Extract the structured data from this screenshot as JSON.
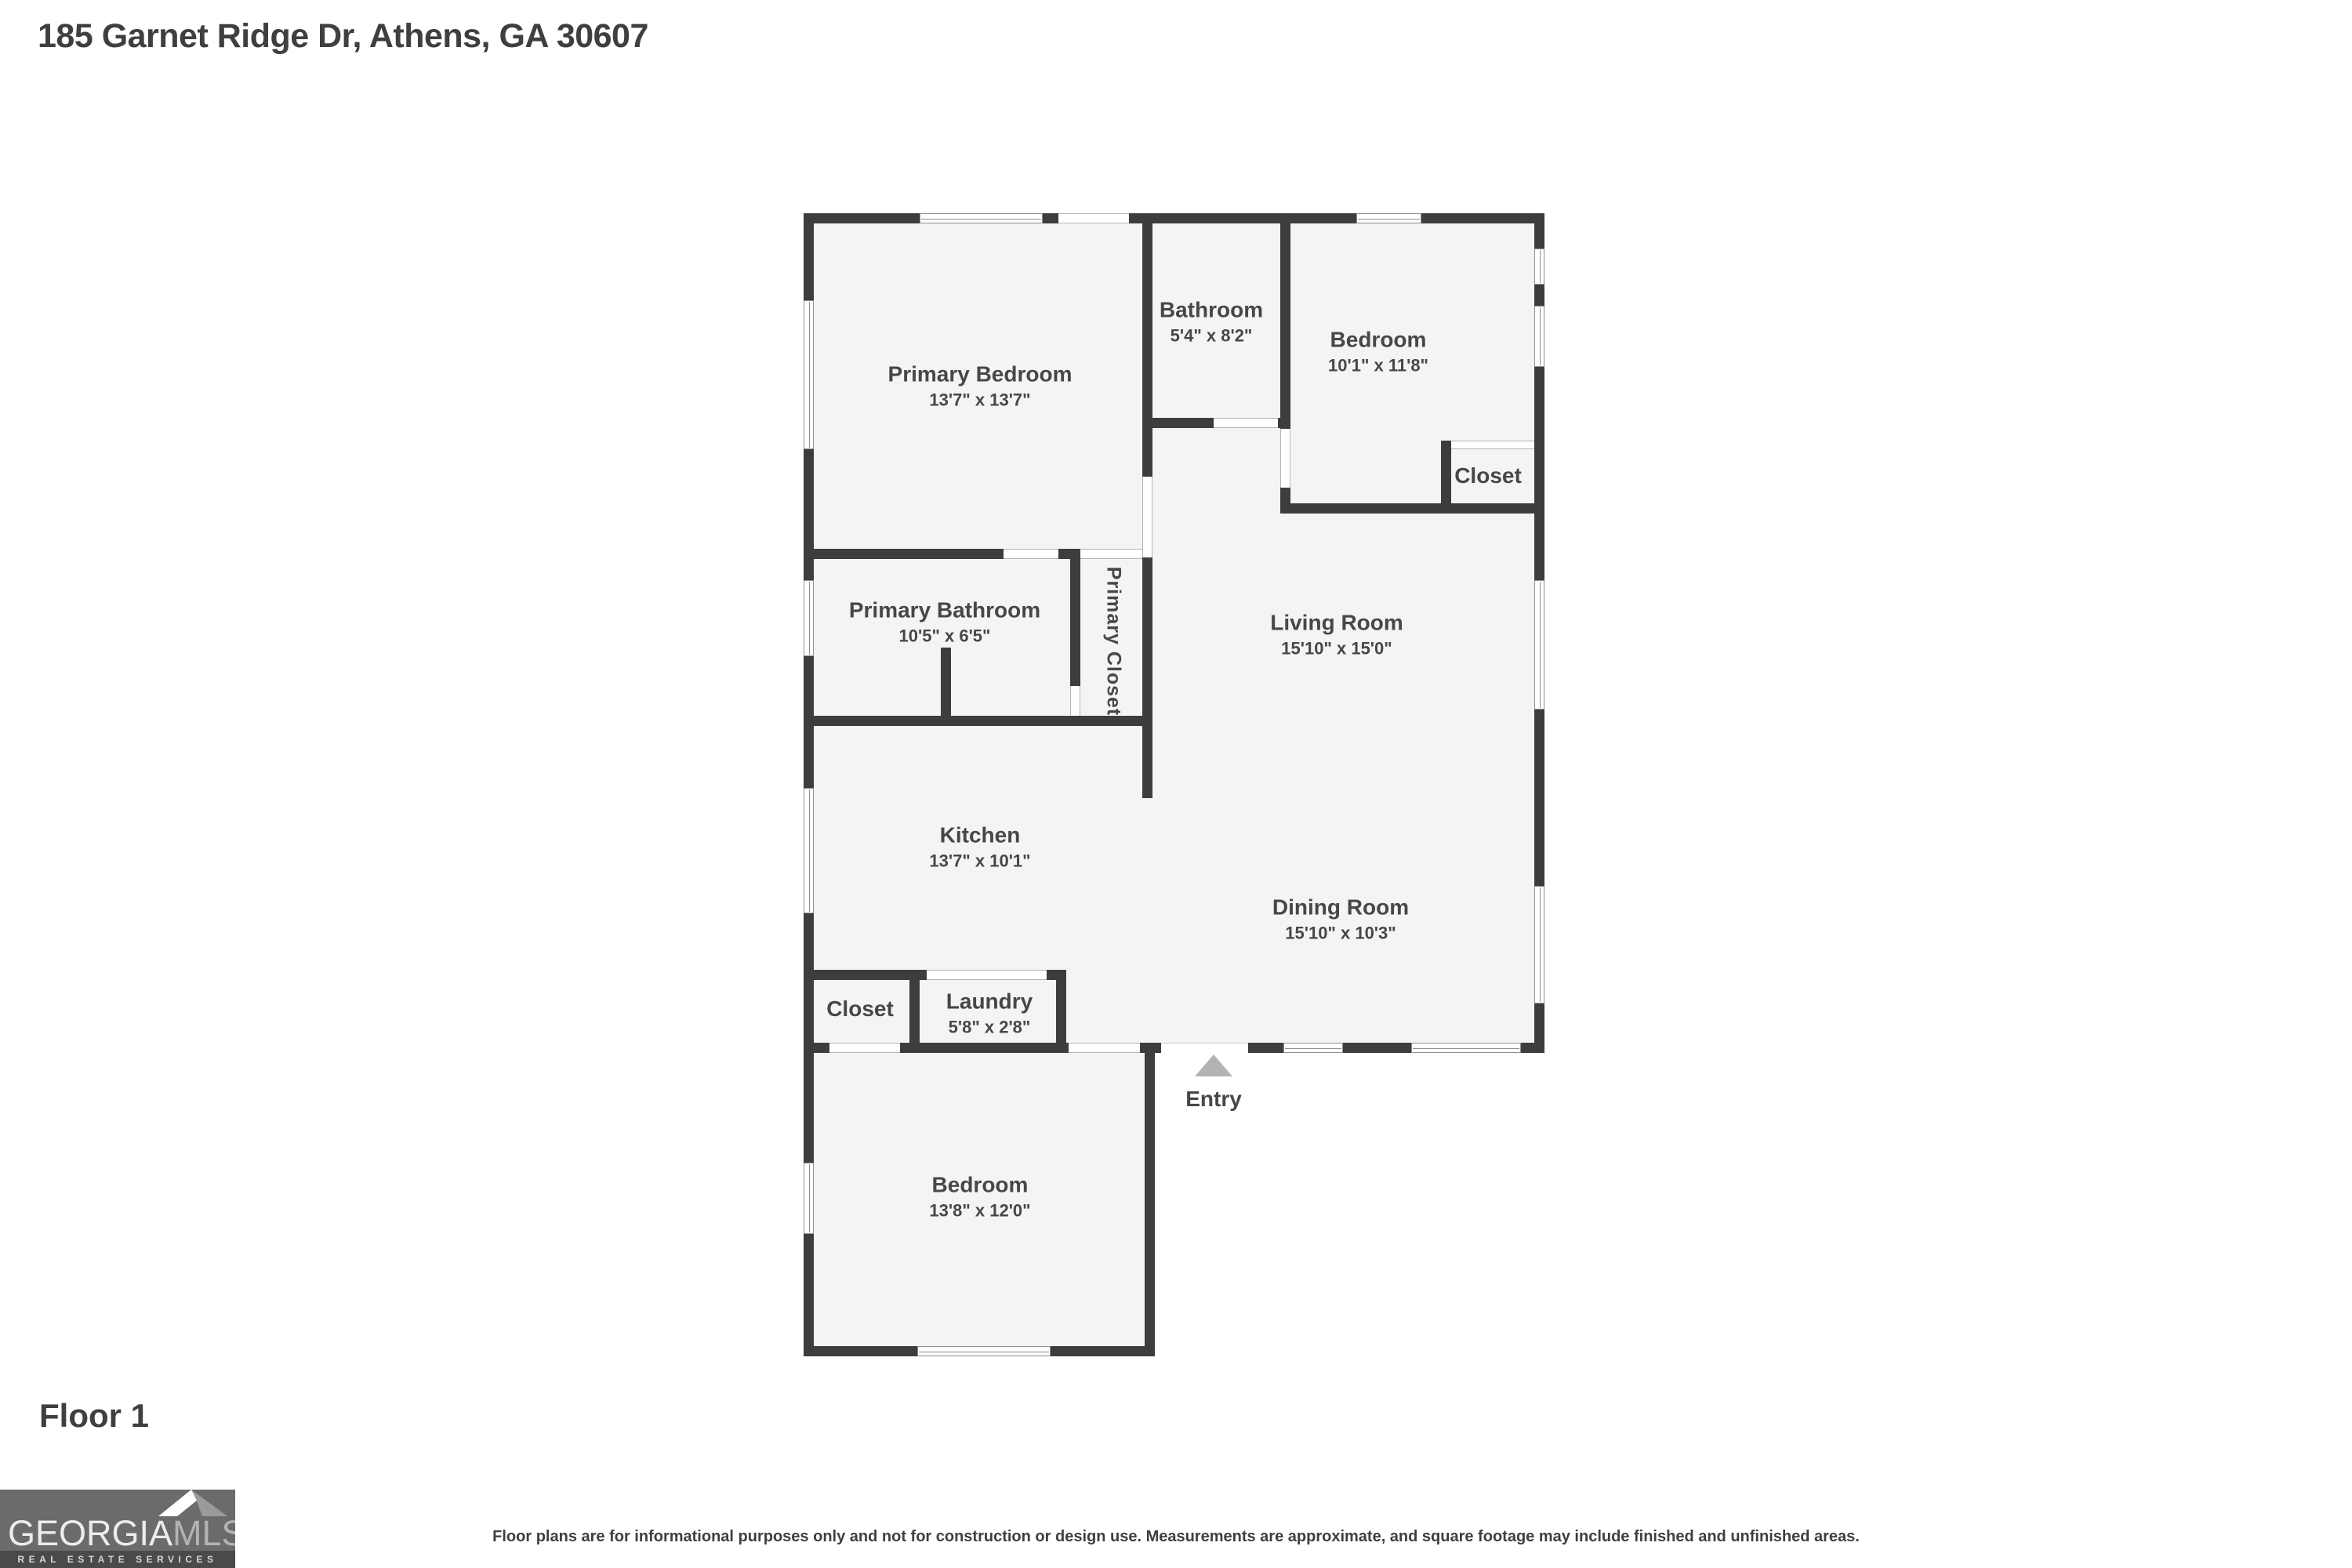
{
  "header": {
    "title": "185 Garnet Ridge Dr, Athens, GA 30607"
  },
  "floor_label": "Floor 1",
  "rooms": {
    "primary_bedroom": {
      "name": "Primary Bedroom",
      "dims": "13'7\" x 13'7\""
    },
    "bathroom": {
      "name": "Bathroom",
      "dims": "5'4\" x 8'2\""
    },
    "bedroom_top": {
      "name": "Bedroom",
      "dims": "10'1\" x 11'8\""
    },
    "closet_bedroom": {
      "name": "Closet"
    },
    "primary_bathroom": {
      "name": "Primary Bathroom",
      "dims": "10'5\" x 6'5\""
    },
    "primary_closet": {
      "name": "Primary Closet"
    },
    "living_room": {
      "name": "Living Room",
      "dims": "15'10\" x 15'0\""
    },
    "kitchen": {
      "name": "Kitchen",
      "dims": "13'7\" x 10'1\""
    },
    "dining_room": {
      "name": "Dining Room",
      "dims": "15'10\" x 10'3\""
    },
    "closet_hall": {
      "name": "Closet"
    },
    "laundry": {
      "name": "Laundry",
      "dims": "5'8\" x 2'8\""
    },
    "bedroom_bottom": {
      "name": "Bedroom",
      "dims": "13'8\" x 12'0\""
    }
  },
  "entry": {
    "label": "Entry"
  },
  "logo": {
    "brand_primary": "GEORGIA",
    "brand_secondary": "MLS",
    "tagline": "REAL ESTATE SERVICES"
  },
  "footer": {
    "disclaimer": "Floor plans are for informational purposes only and not for construction or design use. Measurements are approximate, and square footage may include finished and unfinished areas."
  },
  "colors": {
    "wall": "#3d3d3d",
    "floor": "#f4f4f4",
    "text": "#474747",
    "entry_arrow": "#b3b3b3",
    "logo_bg": "#6b6b6b",
    "logo_strip": "#4a4a4a",
    "logo_roof_light": "#ffffff",
    "logo_roof_dark": "#9b9b9b"
  }
}
